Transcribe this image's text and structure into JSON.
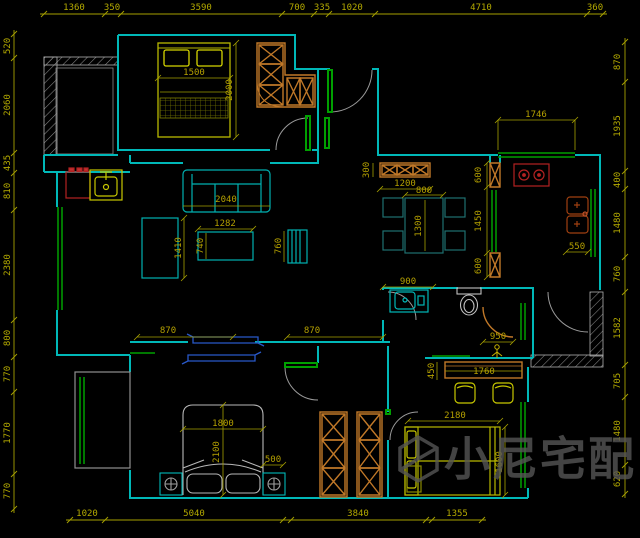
{
  "app": {
    "type": "cad-floor-plan-viewer",
    "background": "#000000"
  },
  "colors": {
    "wall": "#00b8b8",
    "dimension": "#b4aa00",
    "cabinet": "#c07828",
    "appliance_red": "#b42222",
    "window_green": "#00a000",
    "sliding_door_blue": "#2858c8",
    "furniture_yellow": "#c8c800",
    "masonry_gray": "#909090",
    "watermark_gray": "#565656"
  },
  "dimensions": {
    "top": [
      "1360",
      "350",
      "3590",
      "700",
      "335",
      "1020",
      "4710",
      "360"
    ],
    "left": [
      "520",
      "2060",
      "435",
      "810",
      "2380",
      "800",
      "770",
      "1770",
      "770"
    ],
    "right": [
      "870",
      "1935",
      "400",
      "1480",
      "760",
      "1582",
      "705",
      "1480",
      "620"
    ],
    "bottom": [
      "1020",
      "5040",
      "3840",
      "1355"
    ],
    "interior": {
      "bed1_width": "1500",
      "bed1_length": "2000",
      "entry_window": "1746",
      "shoe_cabinet_depth": "300",
      "shoe_cabinet_width": "1200",
      "dining_table_width": "800",
      "dining_table_length": "1300",
      "kitchen_door_top": "600",
      "kitchen_door_middle": "1450",
      "kitchen_door_bottom": "600",
      "kitchen_sink": "550",
      "sofa_width": "2040",
      "tv_cabinet": "1410",
      "coffee_table_width": "1282",
      "coffee_table_depth": "740",
      "tv_stand": "760",
      "bathroom_width": "900",
      "bathroom_depth": "950",
      "desk_depth": "450",
      "desk_width": "1760",
      "corridor_left": "870",
      "corridor_right": "870",
      "bed2_width": "1800",
      "bed2_length": "2100",
      "nightstand": "500",
      "bed3_width": "2180",
      "bed3_length": "1600"
    }
  },
  "watermark": {
    "text": "小尼宅配",
    "logo": "cube-logo"
  }
}
